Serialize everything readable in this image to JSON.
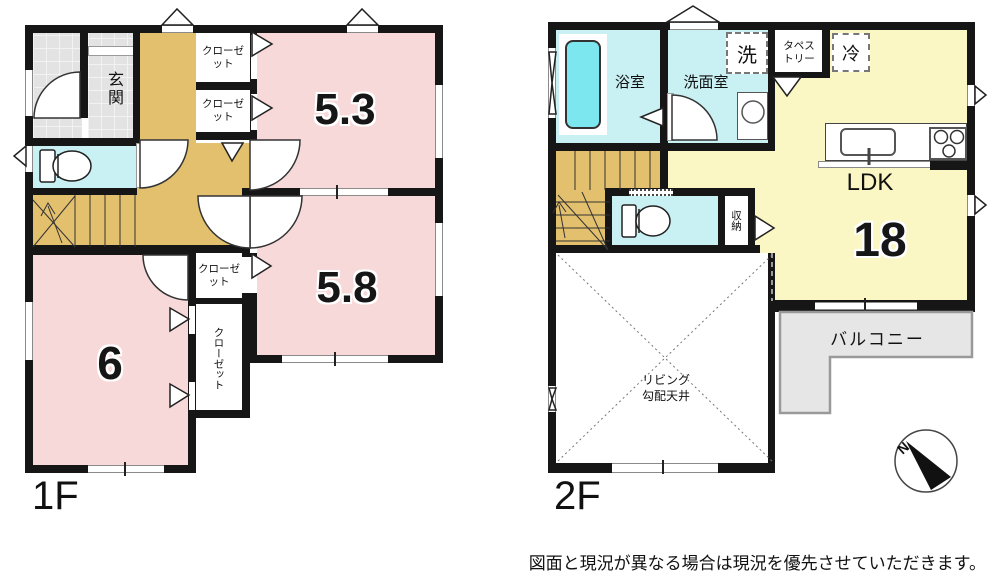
{
  "colors": {
    "room_pink": "#F8D9D9",
    "hall_tan": "#E3C06E",
    "water_cyan": "#C9F1F4",
    "bathtub_cyan": "#7DE7EF",
    "ldk_yellow": "#FAF7C4",
    "balcony_gray": "#E6E6E6",
    "tile_gray": "#E3E3E3",
    "wall_black": "#161616"
  },
  "floor_1f": {
    "floor_label": "1F",
    "entrance_label": "玄関",
    "closet_label": "クローゼット",
    "room_1_tatami": "5.3",
    "room_2_tatami": "5.8",
    "room_3_tatami": "6"
  },
  "floor_2f": {
    "floor_label": "2F",
    "bathroom_label": "浴室",
    "washroom_label": "洗面室",
    "laundry_label": "洗",
    "tapestry_label": "タペストリー",
    "refrigerator_label": "冷",
    "ldk_label": "LDK",
    "ldk_tatami": "18",
    "storage_label": "収納",
    "balcony_label": "バルコニー",
    "void_label_line1": "リビング",
    "void_label_line2": "勾配天井"
  },
  "compass": {
    "north_label": "N"
  },
  "footer": {
    "disclaimer": "図面と現況が異なる場合は現況を優先させていただきます。"
  }
}
